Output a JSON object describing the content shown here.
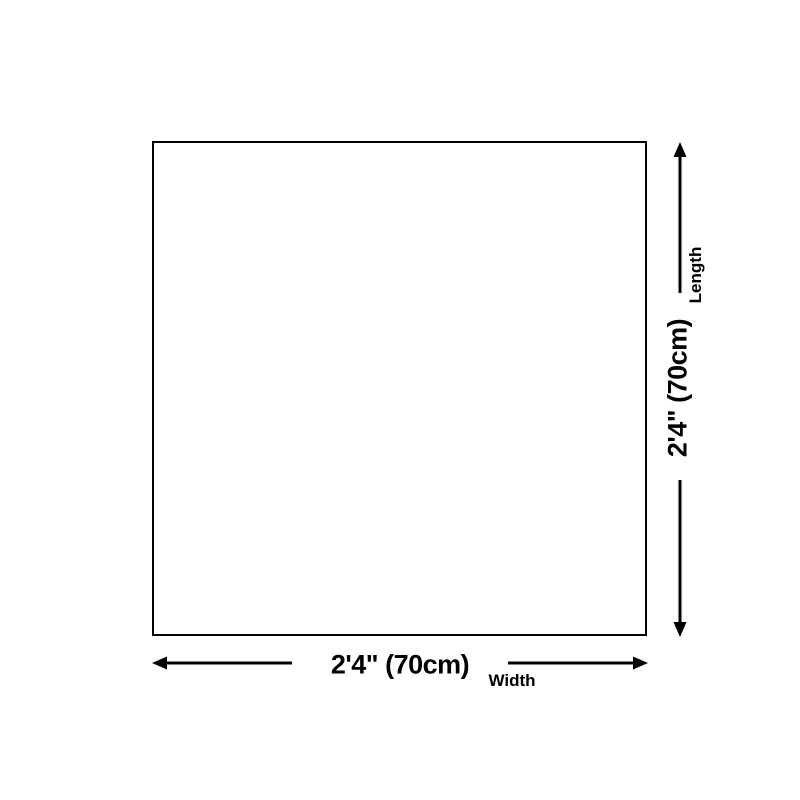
{
  "diagram": {
    "width": {
      "value": "2'4\" (70cm)",
      "label": "Width"
    },
    "length": {
      "value": "2'4\" (70cm)",
      "label": "Length"
    },
    "icons": {
      "width_arrow_left": "arrow-left",
      "width_arrow_right": "arrow-right",
      "length_arrow_up": "arrow-up",
      "length_arrow_down": "arrow-down"
    },
    "colors": {
      "line": "#000000",
      "text": "#000000",
      "background": "#ffffff"
    }
  }
}
